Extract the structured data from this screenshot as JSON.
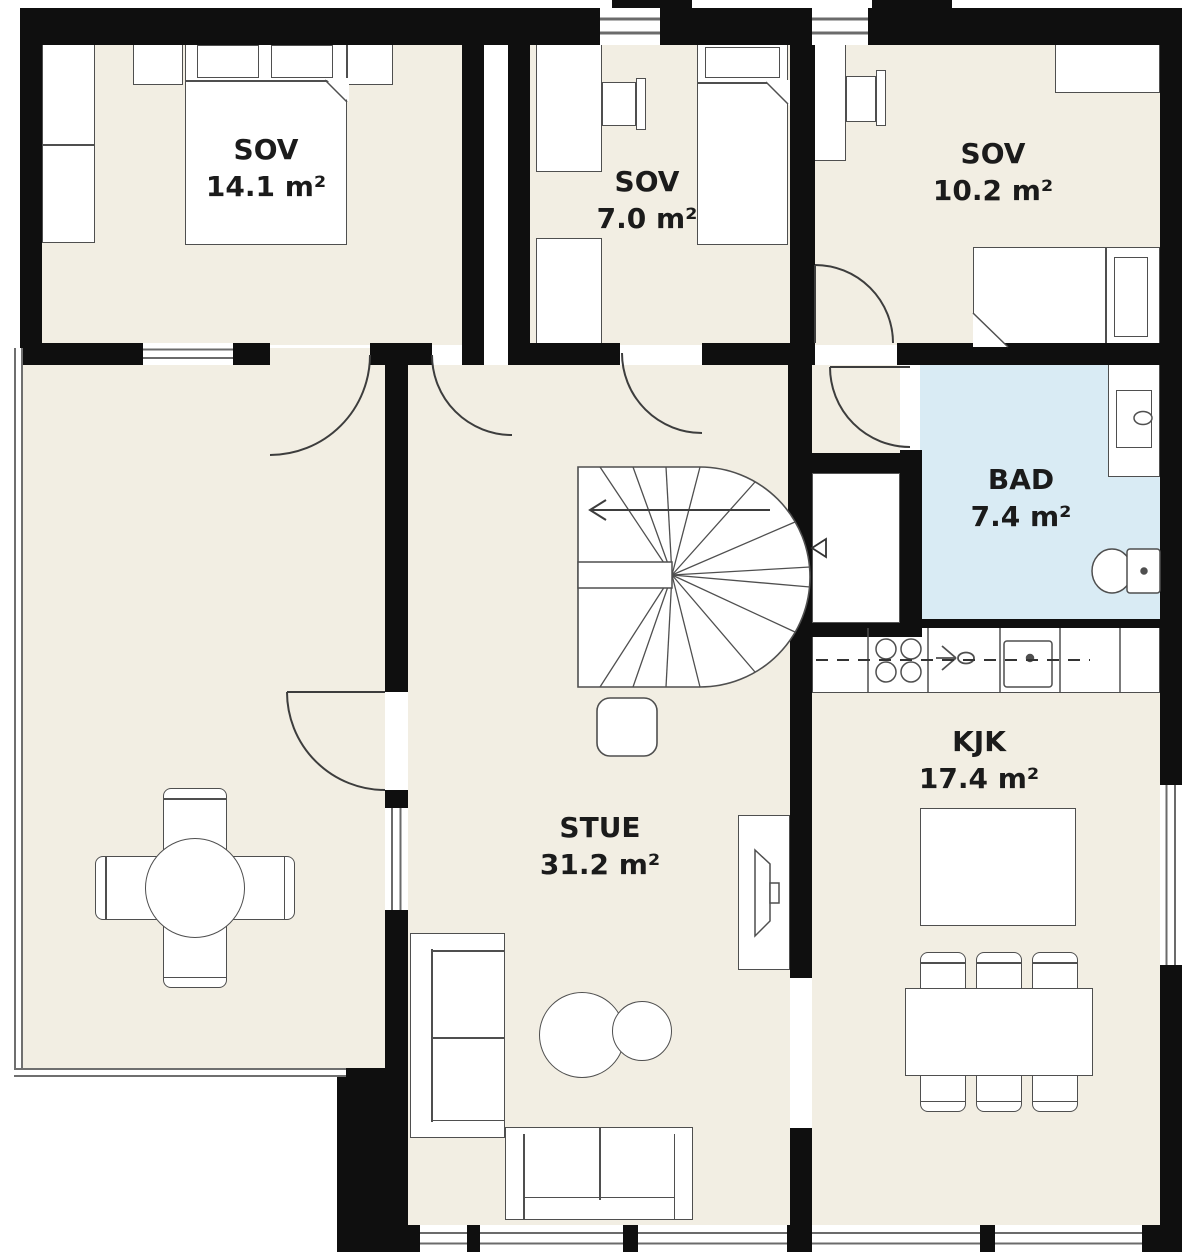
{
  "plan": {
    "title": "floor-plan",
    "rooms": [
      {
        "name": "SOV",
        "area": "14.1 m²"
      },
      {
        "name": "SOV",
        "area": "7.0 m²"
      },
      {
        "name": "SOV",
        "area": "10.2 m²"
      },
      {
        "name": "BAD",
        "area": "7.4 m²"
      },
      {
        "name": "KJK",
        "area": "17.4 m²"
      },
      {
        "name": "STUE",
        "area": "31.2 m²"
      }
    ],
    "colors": {
      "wall": "#0f0f0f",
      "floor": "#f2eee3",
      "bathroom_floor": "#d9ebf4",
      "outline": "#4f4f4f",
      "label": "#1b1b1b"
    }
  }
}
